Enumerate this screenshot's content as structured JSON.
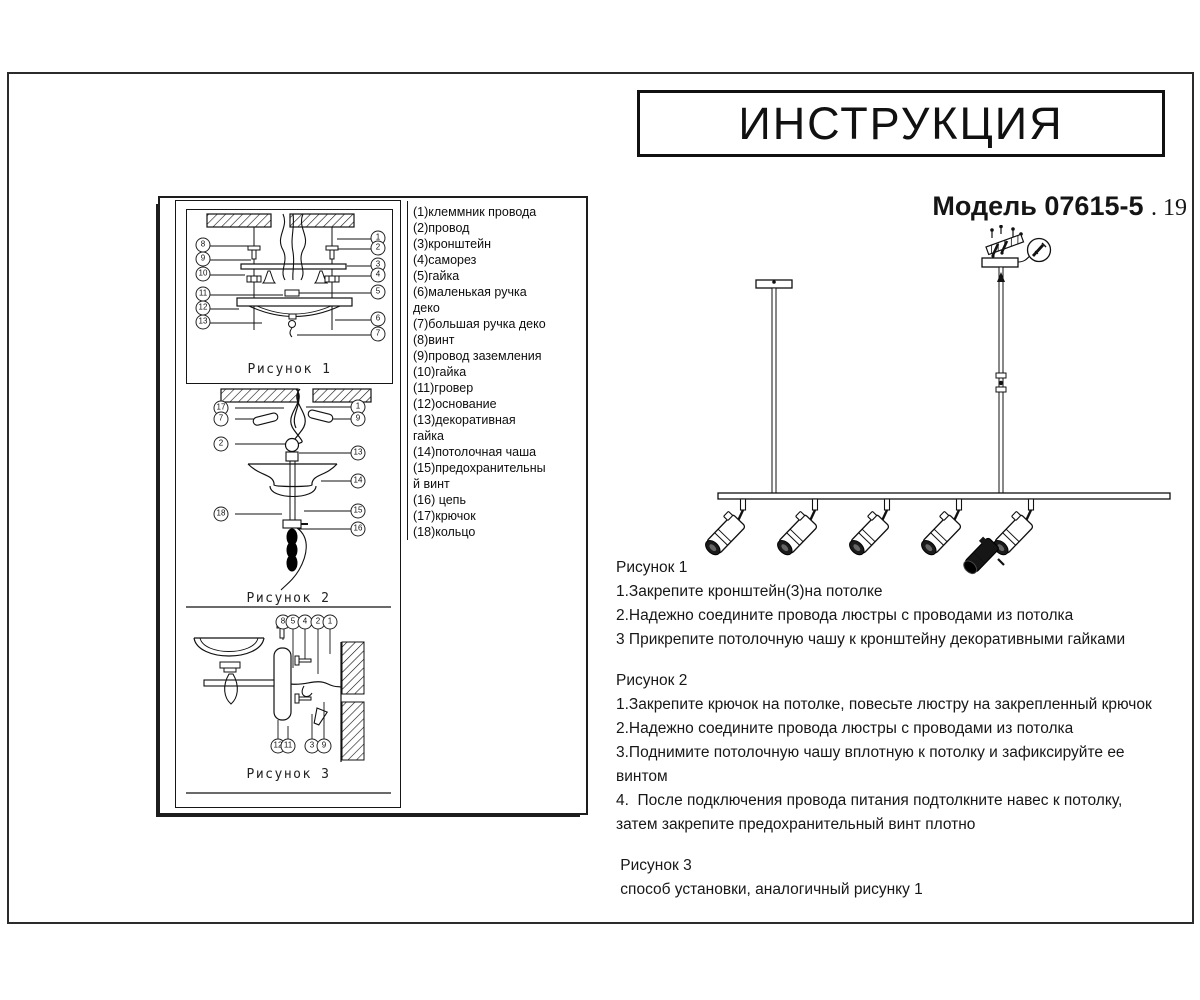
{
  "header": {
    "title": "ИНСТРУКЦИЯ",
    "model": "Модель 07615-5",
    "model_suffix": ". 19"
  },
  "parts_list": {
    "lines": [
      "(1)клеммник провода",
      "(2)провод",
      "(3)кронштейн",
      "(4)саморез",
      "(5)гайка",
      "(6)маленькая ручка",
      "деко",
      "(7)большая ручка деко",
      "(8)винт",
      "(9)провод заземления",
      "(10)гайка",
      "(11)гровер",
      "(12)основание",
      "(13)декоративная",
      "гайка",
      "(14)потолочная чаша",
      "(15)предохранительны",
      "й винт",
      "(16) цепь",
      "(17)крючок",
      "(18)кольцо"
    ]
  },
  "figures": {
    "fig1": {
      "caption": "Рисунок 1",
      "callouts_left": [
        "8",
        "9",
        "10",
        "11",
        "12",
        "13"
      ],
      "callouts_right": [
        "1",
        "2",
        "3",
        "4",
        "5",
        "6",
        "7"
      ]
    },
    "fig2": {
      "caption": "Рисунок 2",
      "callouts_left": [
        "17",
        "7",
        "2",
        "18"
      ],
      "callouts_right": [
        "1",
        "9",
        "13",
        "14",
        "15",
        "16"
      ]
    },
    "fig3": {
      "caption": "Рисунок 3",
      "callouts_top": [
        "8",
        "5",
        "4",
        "2",
        "1"
      ],
      "callouts_bottom": [
        "12",
        "11",
        "3",
        "9"
      ]
    }
  },
  "instructions": {
    "sections": [
      {
        "heading": "Рисунок 1",
        "lines": [
          "1.Закрепите кронштейн(3)на потолке",
          "2.Надежно соедините провода люстры с проводами из потолка",
          "3 Прикрепите потолочную чашу к кронштейну декоративными гайками"
        ]
      },
      {
        "heading": "Рисунок 2",
        "lines": [
          "1.Закрепите крючок на потолке, повесьте люстру на закрепленный крючок",
          "2.Надежно соедините провода люстры с проводами из потолка",
          "3.Поднимите потолочную чашу вплотную к потолку и зафиксируйте ее",
          "винтом",
          "4.  После подключения провода питания подтолкните навес к потолку,",
          "затем закрепите предохранительный винт плотно"
        ]
      },
      {
        "heading": " Рисунок 3",
        "lines": [
          " способ установки, аналогичный рисунку 1"
        ]
      }
    ]
  },
  "colors": {
    "ink": "#1a1a1a",
    "screw_accent": "#5fd0e2"
  }
}
